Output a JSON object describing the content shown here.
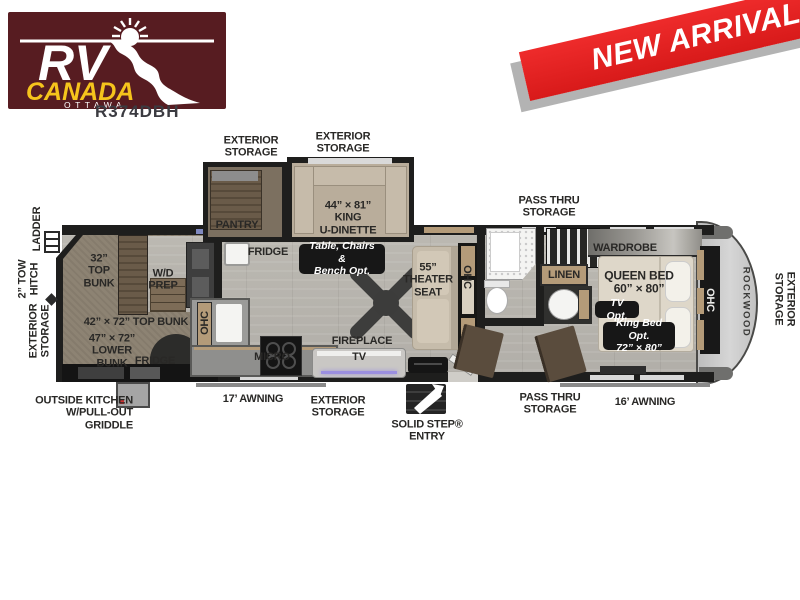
{
  "header": {
    "logo": {
      "rv": "RV",
      "canada": "CANADA",
      "ottawa": "OTTAWA"
    },
    "model": "R374DBH",
    "banner": "NEW ARRIVAL"
  },
  "colors": {
    "logo_bg": "#571c21",
    "canada_yellow": "#f6c41c",
    "banner_red": "#e31e1e",
    "wall": "#1e1e1d",
    "floor": "#b7b4ae",
    "carpet": "#8d8373",
    "cabinet_tan": "#b49b79",
    "option_box": "#171717",
    "led_glow": "#9b8fe0"
  },
  "labels": {
    "ext_storage_top1": "EXTERIOR\nSTORAGE",
    "ext_storage_top2": "EXTERIOR\nSTORAGE",
    "pass_thru_top": "PASS THRU\nSTORAGE",
    "ladder": "LADDER",
    "tow_hitch": "2” TOW\nHITCH",
    "ext_storage_left": "EXTERIOR\nSTORAGE",
    "bunk32": "32”\nTOP\nBUNK",
    "wd_prep": "W/D\nPREP",
    "top_bunk42": "42” × 72” TOP BUNK",
    "lower_bunk47": "47” × 72”\nLOWER\nBUNK",
    "fridge_rear": "FRIDGE",
    "ohc_kitchen": "OHC",
    "pantry": "PANTRY",
    "fridge_main": "FRIDGE",
    "dinette": "44” × 81”\nKING\nU-DINETTE",
    "table_opt": "Table, Chairs &\nBench Opt.",
    "micro": "MICRO",
    "fireplace": "FIREPLACE",
    "tv": "TV",
    "theater": "55”\nTHEATER\nSEAT",
    "ohc_theater": "OHC",
    "linen": "LINEN",
    "wardrobe": "WARDROBE",
    "queen_bed": "QUEEN BED\n60” × 80”",
    "tv_opt": "TV Opt.",
    "king_opt": "King Bed Opt.\n72” × 80”",
    "ohc_bed": "OHC",
    "rockwood": "ROCKWOOD",
    "ext_storage_right": "EXTERIOR\nSTORAGE",
    "outside_kitchen": "OUTSIDE KITCHEN\nW/PULL-OUT\nGRIDDLE",
    "awning17": "17’ AWNING",
    "ext_storage_bottom": "EXTERIOR\nSTORAGE",
    "solid_step": "SOLID STEP®\nENTRY",
    "pass_thru_bottom": "PASS THRU\nSTORAGE",
    "awning16": "16’ AWNING"
  }
}
